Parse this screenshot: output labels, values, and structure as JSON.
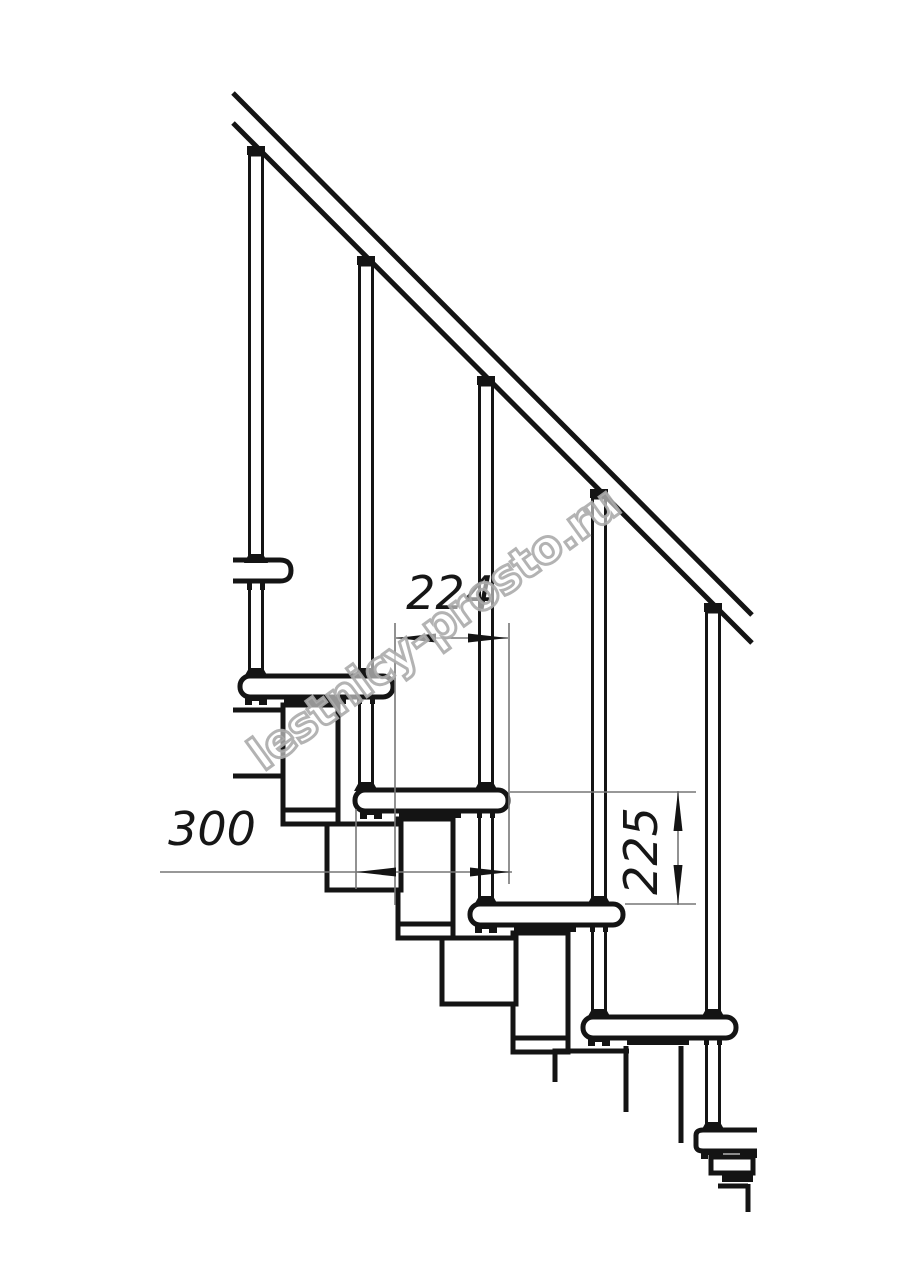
{
  "drawing": {
    "type": "modular-staircase-side-view-technical-drawing",
    "dimensions": {
      "horizontal_step": "224",
      "tread_depth": "300",
      "vertical_rise": "225"
    },
    "watermark": {
      "text": "lestnicy-prosto.ru"
    },
    "colors": {
      "line": "#141414",
      "dimension_line": "#777777",
      "watermark_outline": "#ababab",
      "paper": "#ffffff"
    }
  }
}
